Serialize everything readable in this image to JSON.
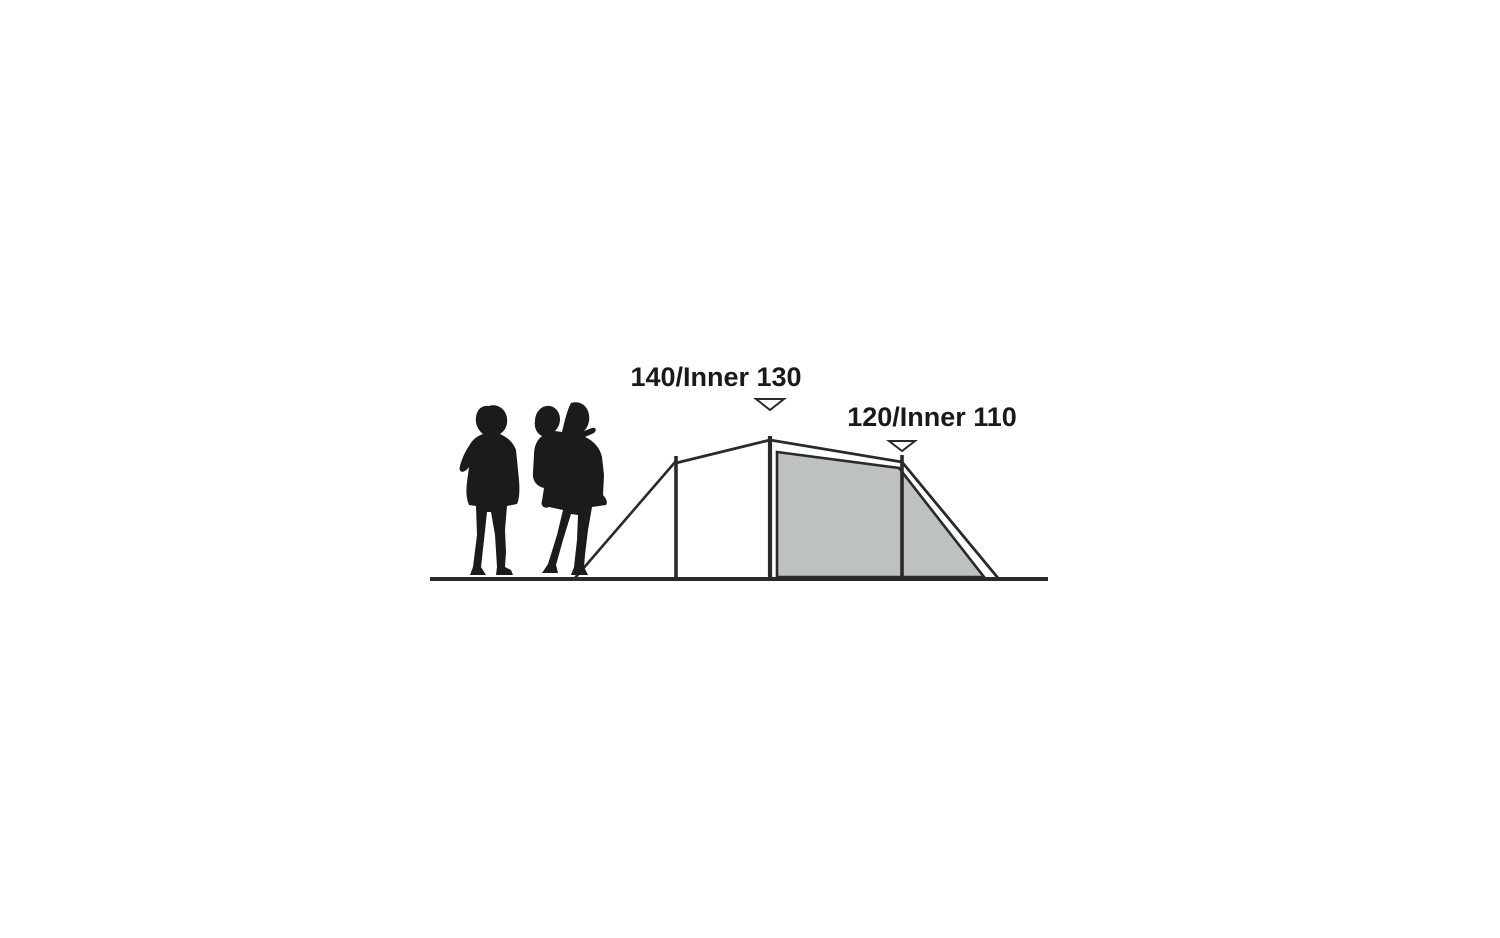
{
  "diagram": {
    "labels": {
      "peak": "140/Inner 130",
      "rear": "120/Inner 110"
    },
    "colors": {
      "background": "#ffffff",
      "line": "#2a2a2a",
      "inner_tent_fill": "#bdc1c0",
      "silhouette": "#1b1b1b",
      "label_text": "#1a1a1a",
      "marker_fill": "#ffffff"
    }
  }
}
